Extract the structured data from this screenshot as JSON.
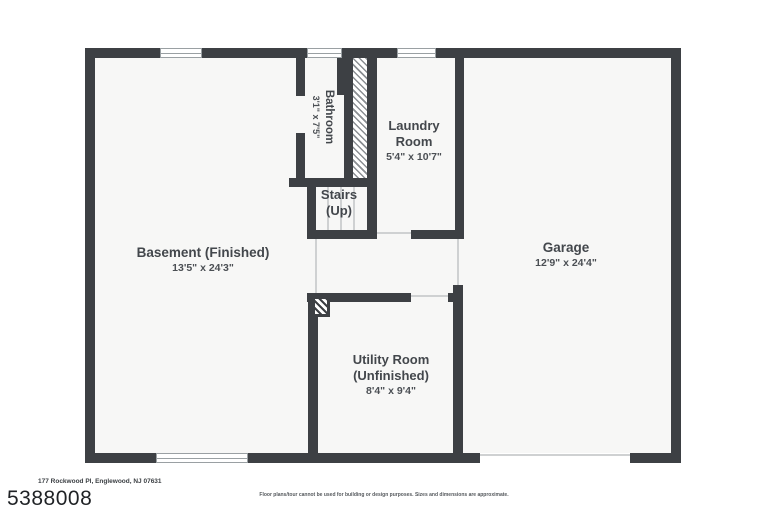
{
  "page": {
    "address": "177 Rockwood Pl, Englewood, NJ 07631",
    "listing_id": "5388008",
    "disclaimer": "Floor plans/tour cannot be used for building or design purposes. Sizes and dimensions are approximate."
  },
  "rooms": {
    "basement": {
      "name": "Basement (Finished)",
      "dims": "13'5\" x 24'3\""
    },
    "bathroom": {
      "name": "Bathroom",
      "dims": "3'1\" x 7'5\""
    },
    "laundry": {
      "line1": "Laundry",
      "line2": "Room",
      "dims": "5'4\" x 10'7\""
    },
    "stairs": {
      "line1": "Stairs",
      "line2": "(Up)"
    },
    "garage": {
      "name": "Garage",
      "dims": "12'9\" x 24'4\""
    },
    "utility": {
      "line1": "Utility Room",
      "line2": "(Unfinished)",
      "dims": "8'4\" x 9'4\""
    }
  },
  "colors": {
    "wall": "#3d4044",
    "floor": "#f7f7f6",
    "label_text": "#43474c",
    "hatch_line": "#8b8f93"
  }
}
